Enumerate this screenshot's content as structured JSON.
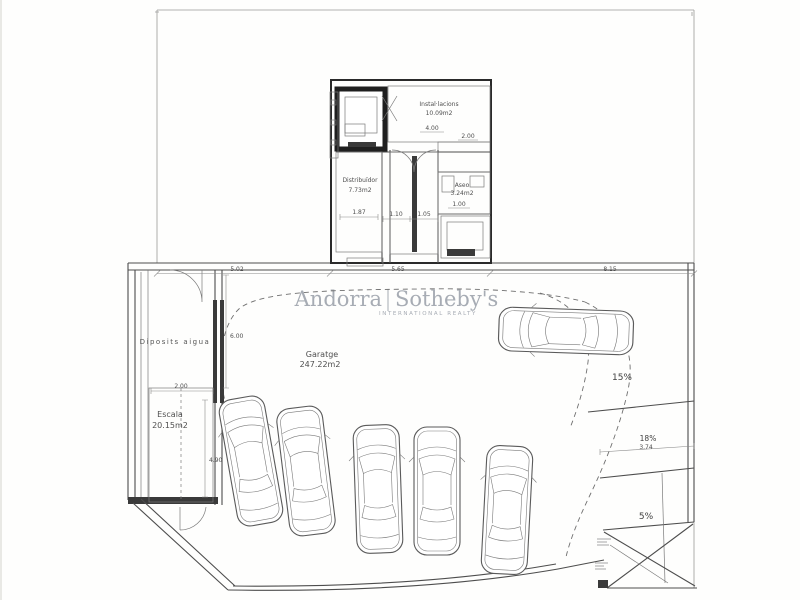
{
  "plan": {
    "watermark": {
      "brand_left": "Andorra",
      "brand_right": "Sotheby's",
      "subtitle": "INTERNATIONAL REALTY"
    },
    "rooms": {
      "installacions": {
        "name": "Instal·lacions",
        "area": "10.09m2"
      },
      "distribuidor": {
        "name": "Distribuïdor",
        "area": "7.73m2"
      },
      "aseo": {
        "name": "Aseo",
        "area": "3.24m2"
      },
      "garatge": {
        "name": "Garatge",
        "area": "247.22m2"
      },
      "escala": {
        "name": "Escala",
        "area": "20.15m2"
      },
      "diposits_aigua": {
        "name": "Diposits aigua"
      }
    },
    "slopes": {
      "upper": "15%",
      "middle": "18%",
      "lower": "5%"
    },
    "dimensions": {
      "garage_top_left": "5.02",
      "garage_top_mid": "5.65",
      "garage_top_right": "8.15",
      "stair_width": "2.00",
      "deposits_height": "6.00",
      "garage_left_height": "4.90",
      "corridor_width": "1.87",
      "stair_bottom_left": "1.10",
      "stair_bottom_right": "1.05",
      "installacions_width": "4.00",
      "installacions_side": "2.00",
      "aseo_width": "1.00",
      "ramp_width": "3.74"
    },
    "vehicles": {
      "parked_count": 5,
      "entering_count": 1
    },
    "colors": {
      "line": "#4d4d4d",
      "wall_dark": "#2a2a2a",
      "hatch_green": "#b9c981",
      "hatch_green_bg": "#f0f2dd",
      "brick_line": "#9a9a9a",
      "watermark": "#a7acb4",
      "paper": "#fefefd"
    }
  }
}
